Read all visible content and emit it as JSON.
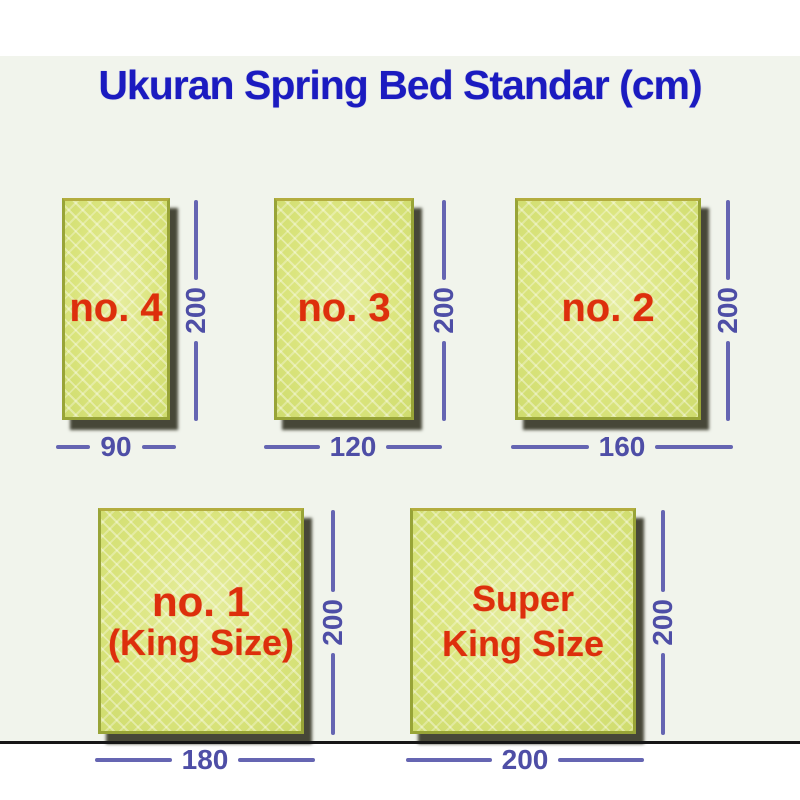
{
  "title": "Ukuran Spring Bed Standar (cm)",
  "colors": {
    "title_blue": "#1b1bc0",
    "dimension_blue": "#5b5bab",
    "label_red": "#dd2f0c",
    "mattress_fill": "#dbe580",
    "mattress_border": "#98a437",
    "mattress_shadow": "#474738",
    "background": "#f1f4ec"
  },
  "beds": [
    {
      "name": "no. 4",
      "width_cm": "90",
      "height_cm": "200"
    },
    {
      "name": "no. 3",
      "width_cm": "120",
      "height_cm": "200"
    },
    {
      "name": "no. 2",
      "width_cm": "160",
      "height_cm": "200"
    },
    {
      "name": "no. 1",
      "name_line2": "(King Size)",
      "width_cm": "180",
      "height_cm": "200"
    },
    {
      "name": "Super",
      "name_line2": "King Size",
      "width_cm": "200",
      "height_cm": "200"
    }
  ]
}
